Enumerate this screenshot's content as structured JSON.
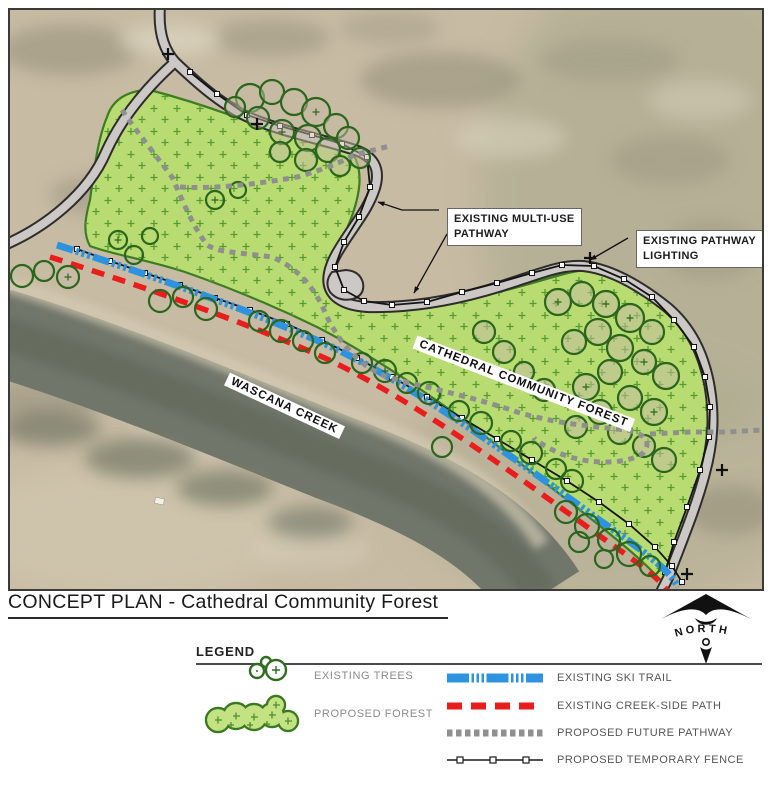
{
  "title": "CONCEPT PLAN - Cathedral Community Forest",
  "map": {
    "callouts": {
      "multi_use": {
        "line1": "EXISTING MULTI-USE",
        "line2": "PATHWAY"
      },
      "lighting": {
        "line1": "EXISTING PATHWAY",
        "line2": "LIGHTING"
      }
    },
    "area_labels": {
      "forest": "CATHEDRAL COMMUNITY FOREST",
      "creek": "WASCANA CREEK"
    }
  },
  "north": {
    "label": "NORTH"
  },
  "legend": {
    "heading": "LEGEND",
    "left_items": [
      {
        "id": "existing-trees",
        "label": "EXISTING TREES"
      },
      {
        "id": "proposed-forest",
        "label": "PROPOSED FOREST"
      }
    ],
    "right_items": [
      {
        "id": "existing-ski-trail",
        "label": "EXISTING SKI TRAIL",
        "color": "#2e93df"
      },
      {
        "id": "existing-creek-side-path",
        "label": "EXISTING CREEK-SIDE PATH",
        "color": "#ea1d1d"
      },
      {
        "id": "proposed-future-pathway",
        "label": "PROPOSED FUTURE PATHWAY",
        "color": "#8f8f8f"
      },
      {
        "id": "proposed-temporary-fence",
        "label": "PROPOSED TEMPORARY FENCE",
        "color": "#1a1a1a"
      }
    ]
  },
  "colors": {
    "aerial_base": "#c7bba3",
    "creek_water": "#70766a",
    "forest_fill": "#b9dc72",
    "forest_stroke": "#3c7d22",
    "tree_stroke": "#2a661c",
    "road_fill": "#cbc8c5",
    "road_casing": "#2e2d2b",
    "ski_trail": "#2e93df",
    "creek_path": "#ea1d1d",
    "future_pathway": "#8f8f8f",
    "fence": "#151515"
  }
}
